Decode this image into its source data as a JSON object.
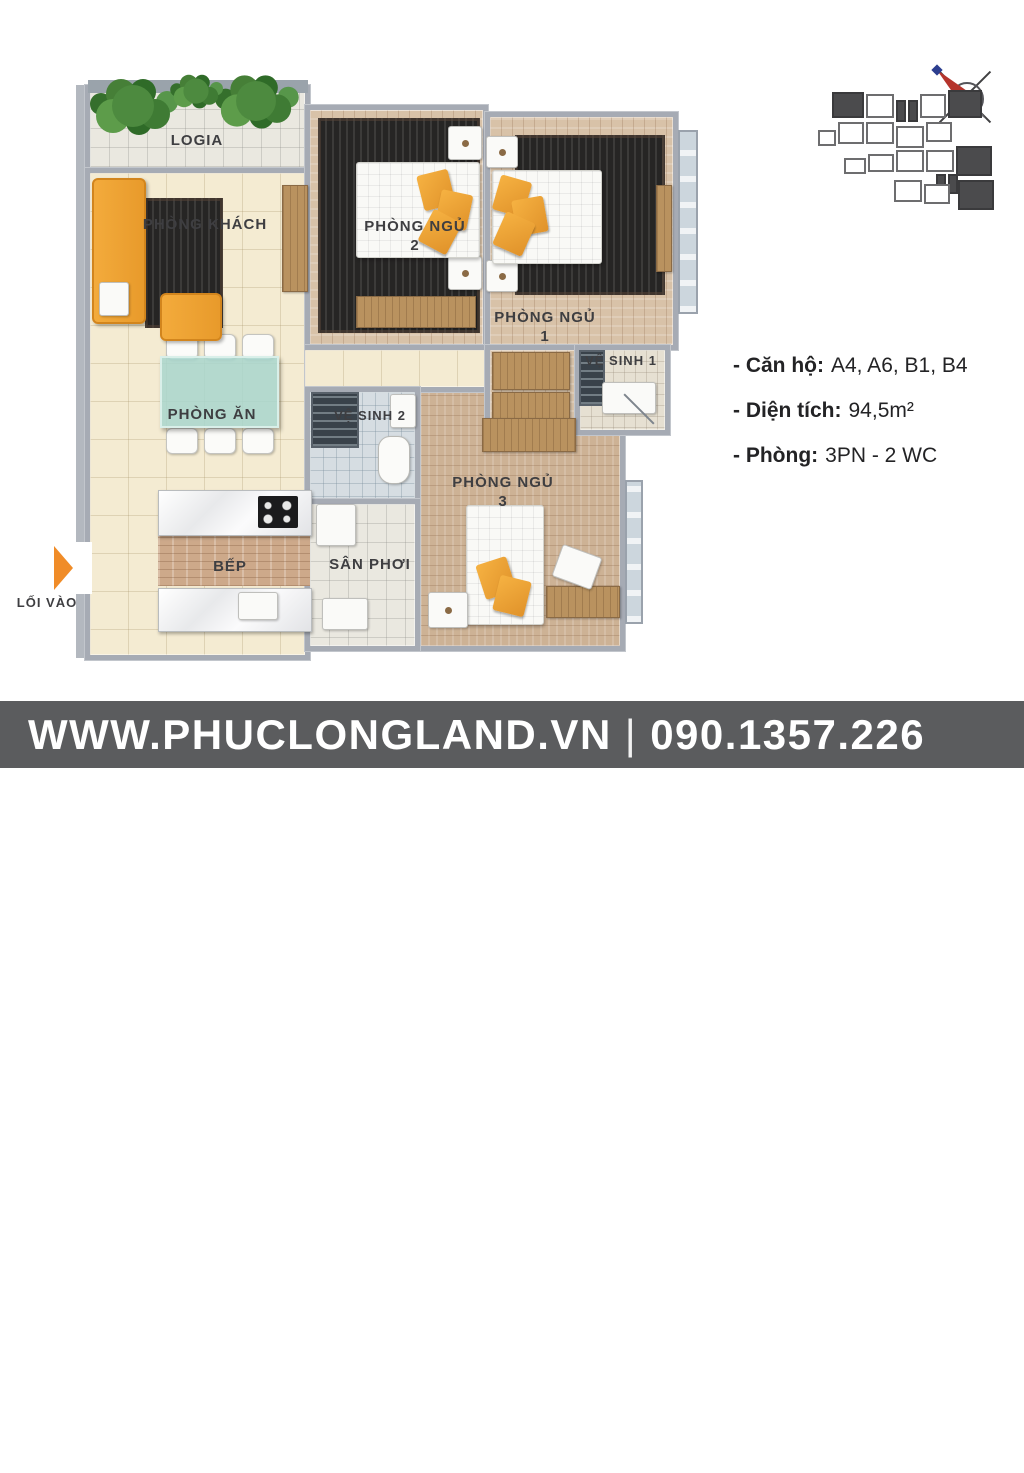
{
  "colors": {
    "accent_orange": "#f2a73d",
    "wall_gray": "#a6abb4",
    "floor_cream": "#f4ebd2",
    "wood_floor": "#d8c2a8",
    "rug_dark": "#262524",
    "footer_bar": "#5b5c5e",
    "compass_red": "#b5342c",
    "entry_arrow_orange": "#f08c28"
  },
  "floorplan": {
    "rooms": [
      {
        "id": "logia",
        "label": "LOGIA"
      },
      {
        "id": "living-room",
        "label": "PHÒNG KHÁCH"
      },
      {
        "id": "bedroom-2",
        "label": "PHÒNG NGỦ",
        "num": "2"
      },
      {
        "id": "bedroom-1",
        "label": "PHÒNG NGỦ",
        "num": "1"
      },
      {
        "id": "bathroom-1",
        "label": "VỆ SINH 1"
      },
      {
        "id": "dining-room",
        "label": "PHÒNG ĂN"
      },
      {
        "id": "bathroom-2",
        "label": "VỆ SINH 2"
      },
      {
        "id": "bedroom-3",
        "label": "PHÒNG NGỦ",
        "num": "3"
      },
      {
        "id": "kitchen",
        "label": "BẾP"
      },
      {
        "id": "drying-yard",
        "label": "SÂN PHƠI"
      }
    ],
    "entrance": {
      "label": "LỐI VÀO"
    }
  },
  "icons": {
    "entry_arrow": "right-arrow-icon",
    "compass": "compass-north-icon"
  },
  "info": {
    "lines": [
      {
        "label": "- Căn hộ:",
        "value": "A4, A6, B1, B4"
      },
      {
        "label": "- Diện tích:",
        "value": "94,5m²"
      },
      {
        "label": "- Phòng:",
        "value": "3PN - 2 WC"
      }
    ]
  },
  "footer": {
    "website": "WWW.PHUCLONGLAND.VN",
    "separator": "|",
    "phone": "090.1357.226",
    "logo": {
      "monogram": "pL",
      "name": "PHÚC LONG",
      "tagline": "REAL ESTATE"
    }
  }
}
